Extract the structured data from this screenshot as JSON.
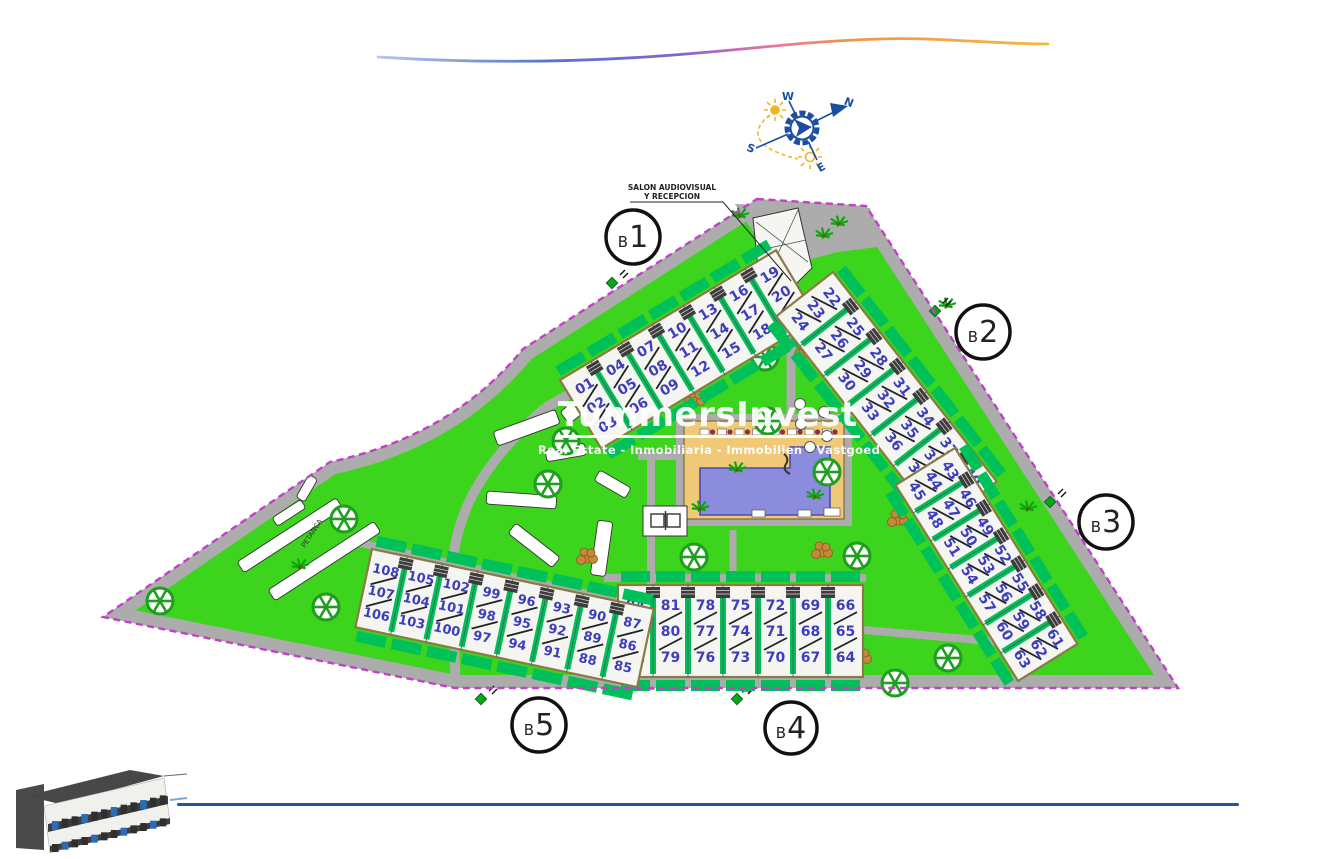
{
  "watermark": {
    "title": "TummersInvest",
    "subtitle": "Real Estate - Inmobiliaria - Immobilien - Vastgoed"
  },
  "annotations": {
    "reception_line1": "SALON AUDIOVISUAL",
    "reception_line2": "Y RECEPCION",
    "petanca": "PETANCA"
  },
  "compass": {
    "n": "N",
    "s": "S",
    "e": "E",
    "w": "W"
  },
  "blocks": [
    {
      "id": "B1",
      "label": "B1"
    },
    {
      "id": "B2",
      "label": "B2"
    },
    {
      "id": "B3",
      "label": "B3"
    },
    {
      "id": "B4",
      "label": "B4"
    },
    {
      "id": "B5",
      "label": "B5"
    }
  ],
  "buildings": [
    {
      "block": "B1",
      "groups": [
        [
          "01",
          "02",
          "03"
        ],
        [
          "04",
          "05",
          "06"
        ],
        [
          "07",
          "08",
          "09"
        ],
        [
          "10",
          "11",
          "12"
        ],
        [
          "13",
          "14",
          "15"
        ],
        [
          "16",
          "17",
          "18"
        ],
        [
          "19",
          "20",
          "21"
        ]
      ]
    },
    {
      "block": "B2",
      "groups": [
        [
          "22",
          "23",
          "24"
        ],
        [
          "25",
          "26",
          "27"
        ],
        [
          "28",
          "29",
          "30"
        ],
        [
          "31",
          "32",
          "33"
        ],
        [
          "34",
          "35",
          "36"
        ],
        [
          "37",
          "38",
          "39"
        ],
        [
          "40",
          "41",
          "42"
        ]
      ]
    },
    {
      "block": "B3",
      "groups": [
        [
          "43",
          "44",
          "45"
        ],
        [
          "46",
          "47",
          "48"
        ],
        [
          "49",
          "50",
          "51"
        ],
        [
          "52",
          "53",
          "54"
        ],
        [
          "55",
          "56",
          "57"
        ],
        [
          "58",
          "59",
          "60"
        ],
        [
          "61",
          "62",
          "63"
        ]
      ]
    },
    {
      "block": "B4",
      "groups": [
        [
          "84",
          "83",
          "82"
        ],
        [
          "81",
          "80",
          "79"
        ],
        [
          "78",
          "77",
          "76"
        ],
        [
          "75",
          "74",
          "73"
        ],
        [
          "72",
          "71",
          "70"
        ],
        [
          "69",
          "68",
          "67"
        ],
        [
          "66",
          "65",
          "64"
        ]
      ]
    },
    {
      "block": "B5",
      "groups": [
        [
          "108",
          "107",
          "106"
        ],
        [
          "105",
          "104",
          "103"
        ],
        [
          "102",
          "101",
          "100"
        ],
        [
          "99",
          "98",
          "97"
        ],
        [
          "96",
          "95",
          "94"
        ],
        [
          "93",
          "92",
          "91"
        ],
        [
          "90",
          "89",
          "88"
        ],
        [
          "87",
          "86",
          "85"
        ]
      ]
    }
  ],
  "icons": {
    "compass": "compass-rose-icon",
    "sun": "sun-path-icon",
    "tree": "wheel-tree-icon",
    "palm": "palm-tree-icon",
    "pool": "swimming-pool",
    "pingpong": "table-tennis-icon",
    "logo": "building-3d-render",
    "swoosh": "gradient-swoosh"
  },
  "colors": {
    "lawn": "#3CD41C",
    "accent_strip": "#00C05A",
    "road": "#ACACAC",
    "boundary": "#C040C8",
    "unit_number": "#3D3DBE",
    "unit_fill": "#F5F5F1",
    "unit_border": "#8A7A45",
    "pool_deck": "#EFC878",
    "pool_water": "#8C8CDC",
    "compass_blue": "#1A4FA0",
    "sun_yellow": "#F0B429",
    "bottom_line": "#24549C",
    "tree_green": "#1F9E1F"
  }
}
